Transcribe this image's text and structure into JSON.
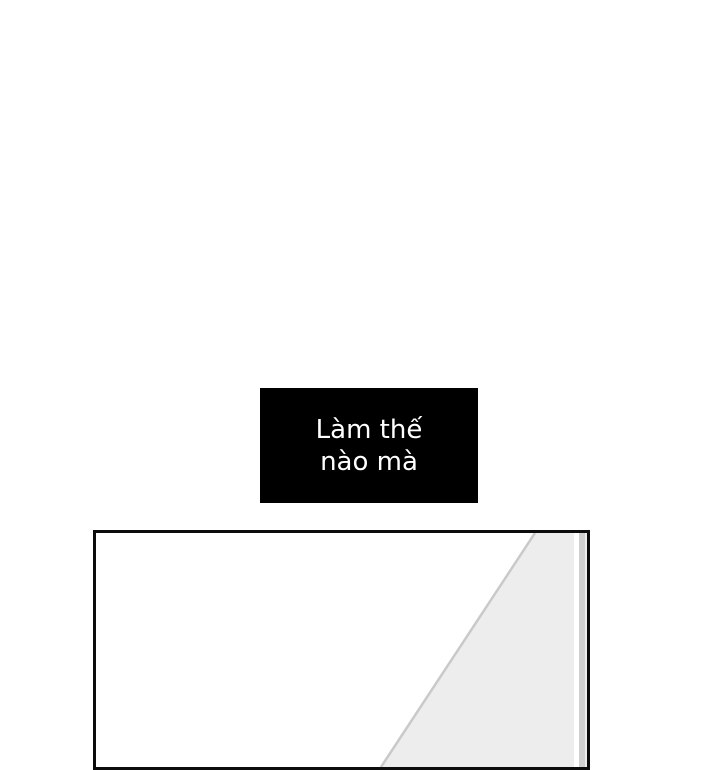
{
  "speech_box": {
    "line1": "Làm thế",
    "line2": "nào mà",
    "bg_color": "#000000",
    "text_color": "#ffffff"
  },
  "panel": {
    "border_color": "#0c0c0c",
    "background_color": "#ffffff",
    "shade_color": "#ededed",
    "diagonal_line_color": "#c9c9c9",
    "stripe_white": "#ffffff",
    "stripe_gray": "#d0d0d0",
    "stripe_light": "#ececec"
  }
}
